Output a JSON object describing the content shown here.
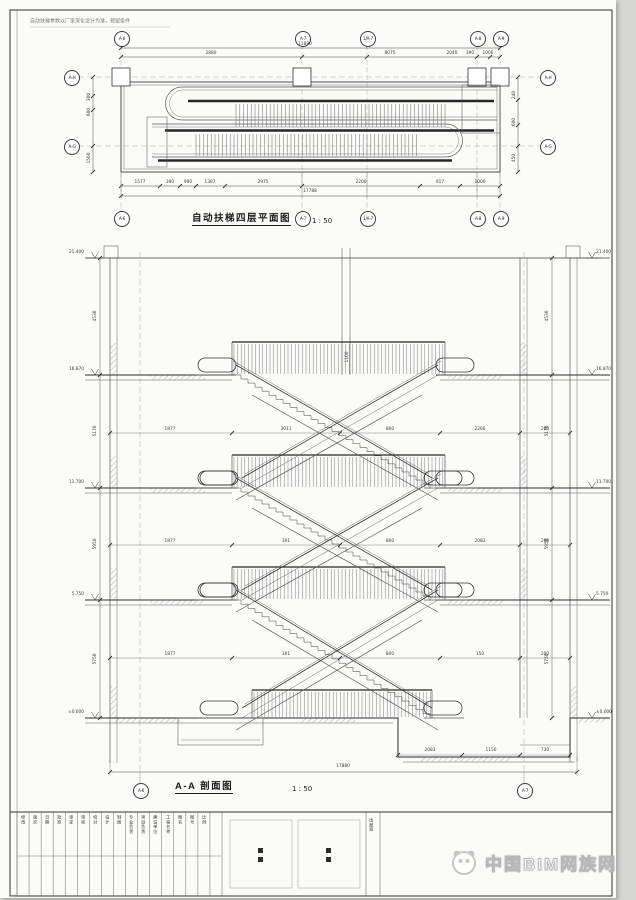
{
  "sheet": {
    "top_note": "自动扶梯参数以厂家深化设计为准，预留条件",
    "sheet_mark": "4#",
    "watermark_text": "中国BIM网族网"
  },
  "plan": {
    "title": "自动扶梯四层平面图",
    "scale": "1 : 50",
    "grid_top": [
      "A-6",
      "A-7",
      "1/A-7",
      "A-8",
      "A-9"
    ],
    "grid_bottom": [
      "A-6",
      "A-7",
      "1/A-7",
      "A-8",
      "A-9"
    ],
    "grid_left": [
      "A-H",
      "A-G"
    ],
    "grid_right": [
      "A-H",
      "A-G"
    ],
    "dim_total_top": "11880",
    "dims_top": [
      "2880",
      "8075",
      "2040",
      "390",
      "1000"
    ],
    "dims_bottom": [
      "1577",
      "390",
      "990",
      "1387",
      "2975",
      "2200",
      "917",
      "1000"
    ],
    "dim_total_bottom": "17788",
    "dims_left": [
      "300",
      "600",
      "1560"
    ],
    "dims_right": [
      "240",
      "600",
      "450"
    ]
  },
  "section": {
    "title": "A-A 剖面图",
    "scale": "1 : 50",
    "grid_bottom": [
      "A-6",
      "A-7"
    ],
    "levels_left": [
      "21.400",
      "16.870",
      "11.700",
      "5.750",
      "±0.000"
    ],
    "levels_right": [
      "21.400",
      "16.870",
      "11.700",
      "5.750",
      "±0.000"
    ],
    "dims_left": [
      "4530",
      "5170",
      "5950",
      "5750"
    ],
    "dims_right": [
      "4530",
      "5170",
      "5950",
      "5750"
    ],
    "dim_total_bottom": "17880",
    "pit_dims": [
      "2083",
      "1150",
      "730"
    ],
    "floor_dims_4f": [
      "1877",
      "3011",
      "800",
      "2260",
      "200"
    ],
    "floor_dims_3f": [
      "1877",
      "301",
      "800",
      "2083",
      "200"
    ],
    "floor_dims_2f": [
      "1877",
      "301",
      "800",
      "150",
      "200"
    ],
    "railing_dim": "1100"
  },
  "titleblock": {
    "columns": [
      "修改",
      "版次",
      "日期",
      "批准",
      "审定",
      "审核",
      "校对",
      "设计",
      "制图",
      "专业负责",
      "项目负责",
      "建设单位",
      "工程名称",
      "图名",
      "图号",
      "比例"
    ],
    "stamp_note": "出图章"
  }
}
